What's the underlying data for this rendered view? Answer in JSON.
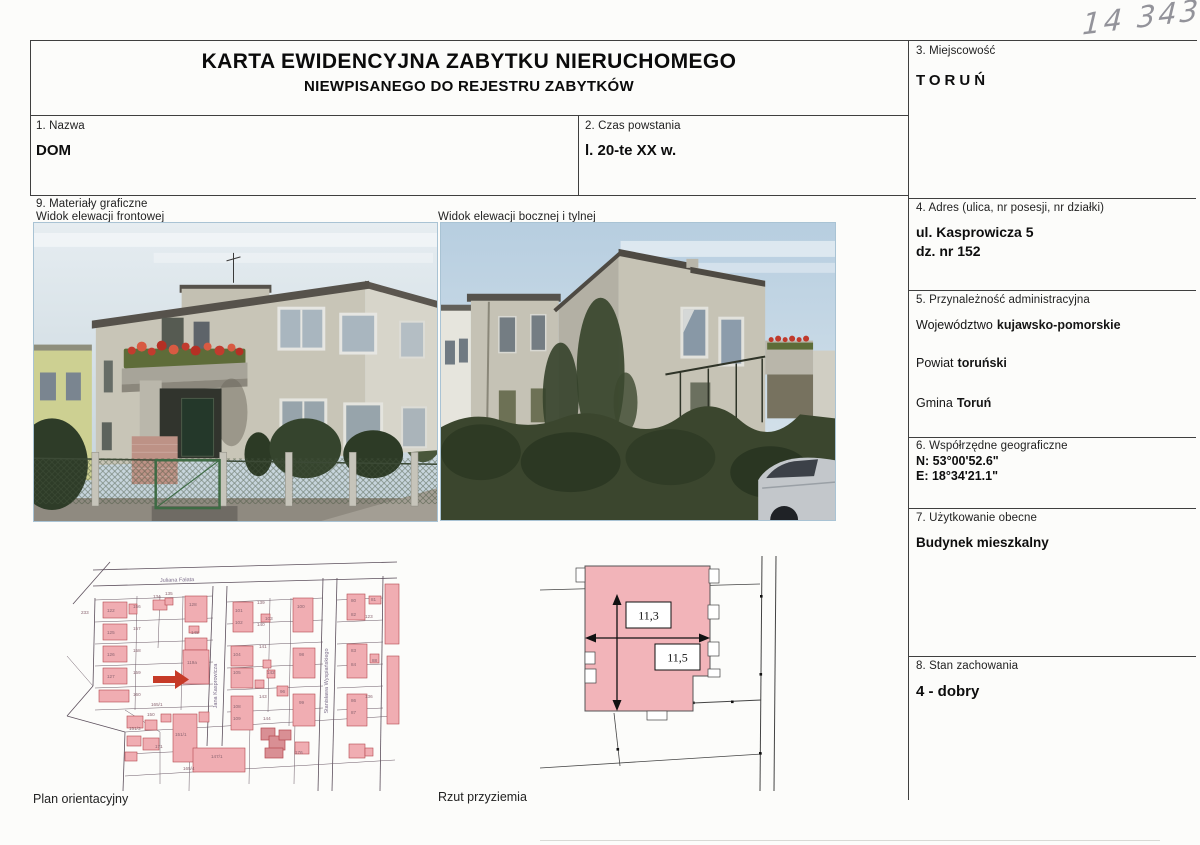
{
  "annotation_number": "14 343",
  "header": {
    "title": "KARTA EWIDENCYJNA ZABYTKU NIERUCHOMEGO",
    "subtitle": "NIEWPISANEGO DO REJESTRU ZABYTKÓW"
  },
  "sections": {
    "s1": {
      "label": "1. Nazwa",
      "value": "DOM"
    },
    "s2": {
      "label": "2. Czas powstania",
      "value": "l. 20-te XX w."
    },
    "s3": {
      "label": "3. Miejscowość",
      "value": "TORUŃ"
    },
    "s4": {
      "label": "4. Adres (ulica, nr posesji, nr działki)",
      "address_line1": "ul. Kasprowicza 5",
      "address_line2": "dz. nr 152"
    },
    "s5": {
      "label": "5. Przynależność administracyjna",
      "rows": [
        {
          "k": "Województwo",
          "v": "kujawsko-pomorskie"
        },
        {
          "k": "Powiat",
          "v": "toruński"
        },
        {
          "k": "Gmina",
          "v": "Toruń"
        }
      ]
    },
    "s6": {
      "label": "6. Współrzędne geograficzne",
      "lat": "N: 53°00'52.6\"",
      "lon": "E: 18°34'21.1\""
    },
    "s7": {
      "label": "7. Użytkowanie obecne",
      "value": "Budynek mieszkalny"
    },
    "s8": {
      "label": "8. Stan zachowania",
      "value": "4 - dobry"
    },
    "s9": {
      "label": "9. Materiały graficzne",
      "photo1_caption": "Widok elewacji frontowej",
      "photo2_caption": "Widok elewacji bocznej i tylnej"
    }
  },
  "map": {
    "caption": "Plan orientacyjny",
    "streets": {
      "top": "Juliana Fałata",
      "vertical1": "Jana Kasprowicza",
      "vertical2": "Stanisława Wyspiańskiego"
    },
    "parcel_numbers": [
      {
        "x": 16,
        "y": 58,
        "n": "233"
      },
      {
        "x": 68,
        "y": 52,
        "n": "156"
      },
      {
        "x": 42,
        "y": 56,
        "n": "122"
      },
      {
        "x": 68,
        "y": 74,
        "n": "157"
      },
      {
        "x": 42,
        "y": 78,
        "n": "125"
      },
      {
        "x": 68,
        "y": 96,
        "n": "158"
      },
      {
        "x": 42,
        "y": 100,
        "n": "126"
      },
      {
        "x": 68,
        "y": 118,
        "n": "159"
      },
      {
        "x": 42,
        "y": 122,
        "n": "127"
      },
      {
        "x": 68,
        "y": 140,
        "n": "160"
      },
      {
        "x": 86,
        "y": 150,
        "n": "165/1"
      },
      {
        "x": 88,
        "y": 42,
        "n": "134"
      },
      {
        "x": 100,
        "y": 39,
        "n": "135"
      },
      {
        "x": 124,
        "y": 50,
        "n": "128"
      },
      {
        "x": 126,
        "y": 78,
        "n": "148"
      },
      {
        "x": 122,
        "y": 108,
        "n": "119a"
      },
      {
        "x": 170,
        "y": 56,
        "n": "101"
      },
      {
        "x": 170,
        "y": 68,
        "n": "102"
      },
      {
        "x": 192,
        "y": 48,
        "n": "139"
      },
      {
        "x": 192,
        "y": 70,
        "n": "140"
      },
      {
        "x": 200,
        "y": 64,
        "n": "103"
      },
      {
        "x": 168,
        "y": 100,
        "n": "104"
      },
      {
        "x": 168,
        "y": 118,
        "n": "105"
      },
      {
        "x": 194,
        "y": 92,
        "n": "141"
      },
      {
        "x": 202,
        "y": 118,
        "n": "142"
      },
      {
        "x": 215,
        "y": 137,
        "n": "96"
      },
      {
        "x": 194,
        "y": 142,
        "n": "143"
      },
      {
        "x": 168,
        "y": 152,
        "n": "108"
      },
      {
        "x": 168,
        "y": 164,
        "n": "109"
      },
      {
        "x": 198,
        "y": 164,
        "n": "144"
      },
      {
        "x": 232,
        "y": 52,
        "n": "100"
      },
      {
        "x": 234,
        "y": 100,
        "n": "98"
      },
      {
        "x": 234,
        "y": 148,
        "n": "99"
      },
      {
        "x": 286,
        "y": 46,
        "n": "80"
      },
      {
        "x": 306,
        "y": 45,
        "n": "81"
      },
      {
        "x": 286,
        "y": 60,
        "n": "82"
      },
      {
        "x": 300,
        "y": 62,
        "n": "123"
      },
      {
        "x": 286,
        "y": 96,
        "n": "83"
      },
      {
        "x": 286,
        "y": 110,
        "n": "84"
      },
      {
        "x": 307,
        "y": 106,
        "n": "88"
      },
      {
        "x": 286,
        "y": 146,
        "n": "86"
      },
      {
        "x": 286,
        "y": 158,
        "n": "87"
      },
      {
        "x": 300,
        "y": 142,
        "n": "136"
      },
      {
        "x": 110,
        "y": 180,
        "n": "151/1"
      },
      {
        "x": 64,
        "y": 174,
        "n": "151/3"
      },
      {
        "x": 146,
        "y": 202,
        "n": "147/1"
      },
      {
        "x": 90,
        "y": 192,
        "n": "171"
      },
      {
        "x": 118,
        "y": 214,
        "n": "165/4"
      },
      {
        "x": 230,
        "y": 198,
        "n": "176"
      },
      {
        "x": 82,
        "y": 160,
        "n": "150"
      }
    ]
  },
  "plan": {
    "caption": "Rzut przyziemia",
    "height_dim": "11,3",
    "width_dim": "11,5"
  },
  "colors": {
    "map_building_fill": "#f0adb2",
    "map_building_stroke": "#b5494f",
    "plan_building_fill": "#f2b4b9",
    "arrow_red": "#c63a27"
  }
}
